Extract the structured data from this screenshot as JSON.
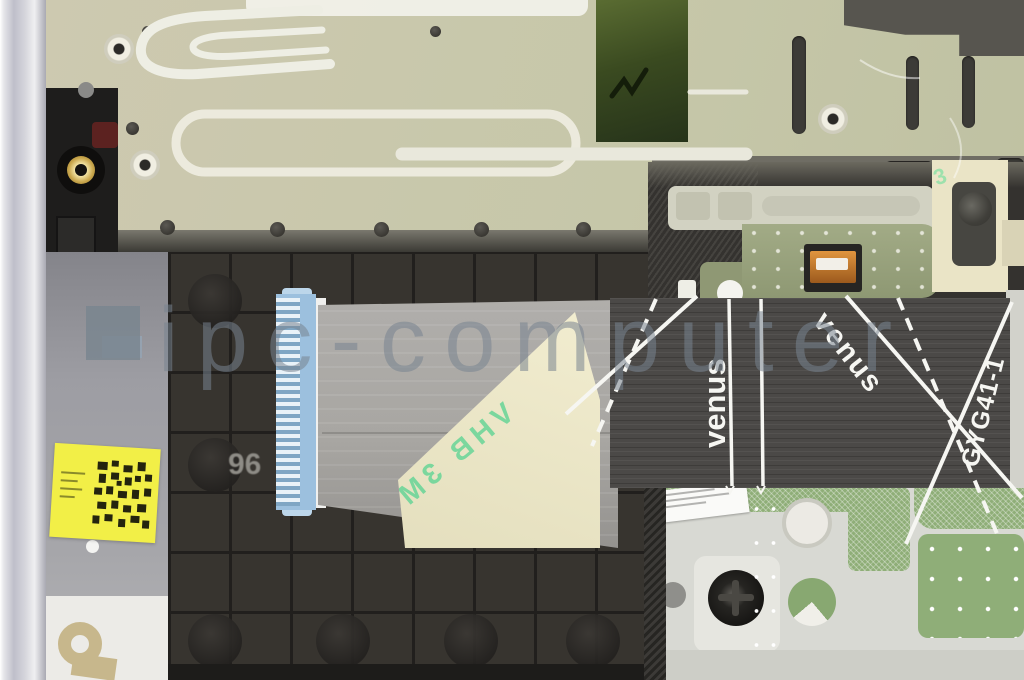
{
  "scene": {
    "description": "Top view of a laptop palmrest internal assembly: metal keyboard backplate (top), black keyboard key grid (left), grey flex ribbon cable with 3M VHB tape liner (center), touchpad module with green PCB pads (bottom right)",
    "watermark": {
      "text": "ipc-computer"
    },
    "flex_cable": {
      "label_vertical": "venus",
      "label_diagonal": "venus",
      "part_number": "GYG41-1"
    },
    "tape_liner": {
      "print_row_1": "3M VHB",
      "print_row_2": "VHB 3M",
      "corner_mark": "3"
    },
    "key_grid": {
      "mold_mark": "9077 AK",
      "edge_mark": "96"
    },
    "colors": {
      "backplate": "#c9c6ac",
      "key_grid": "#37342f",
      "cable_light": "#a8a6a2",
      "cable_dark": "#4b4947",
      "tape_cream": "#ece7c8",
      "tape_print_green": "#5fd494",
      "pcb_green": "#8fae78",
      "sticker_yellow": "#f0ee3e",
      "watermark_gray": "#7e8894",
      "bracket_sage": "#9aa47e"
    }
  }
}
